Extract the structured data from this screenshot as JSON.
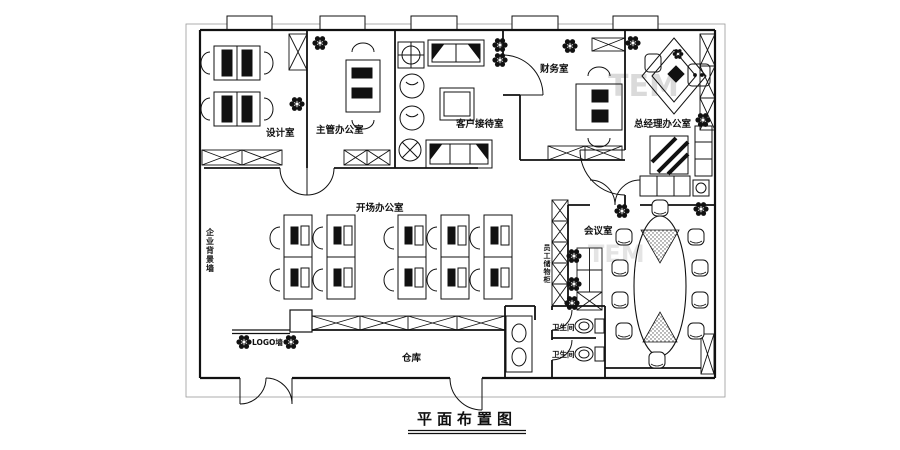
{
  "title": {
    "text": "平面布置图"
  },
  "watermark": {
    "text": "TEM"
  },
  "rooms": {
    "design": {
      "label": "设计室"
    },
    "supervisor": {
      "label": "主管办公室"
    },
    "reception": {
      "label": "客户接待室"
    },
    "finance": {
      "label": "财务室"
    },
    "general_manager": {
      "label": "总经理办公室"
    },
    "open_office": {
      "label": "开场办公室"
    },
    "meeting": {
      "label": "会议室"
    },
    "warehouse": {
      "label": "仓库"
    },
    "toilet_1": {
      "label": "卫生间"
    },
    "toilet_2": {
      "label": "卫生间"
    }
  },
  "walls": {
    "corporate_background_wall": {
      "label": "企业背景墙"
    },
    "logo_wall": {
      "label": "LOGO墙"
    },
    "staff_lockers": {
      "label": "员工储物柜"
    }
  },
  "icons": {
    "plant": "plant-cluster"
  },
  "colors": {
    "line": "#111111",
    "watermark": "#bdbdbd"
  }
}
